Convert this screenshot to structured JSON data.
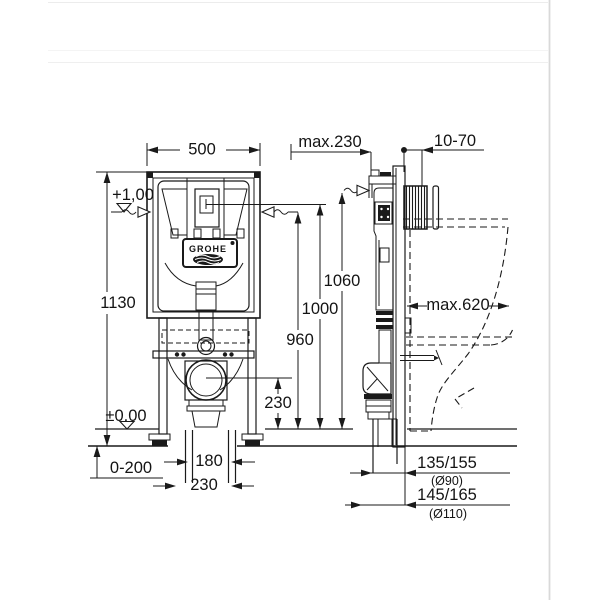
{
  "page": {
    "ink_color": "#1a1a1a",
    "divider_color": "#d9d9d9"
  },
  "front_view": {
    "dim_width_top": "500",
    "dim_height_left": "1130",
    "level_upper": "+1,00",
    "level_floor": "±0,00",
    "dim_floor_buildup": "0-200",
    "dim_pipe_spacing": "180",
    "dim_pipe_offset": "230",
    "dim_outlet_height": "230",
    "brand": "GROHE"
  },
  "side_view": {
    "dim_depth": "max.230",
    "dim_plate_depth": "10-70",
    "dim_h1": "1060",
    "dim_h2": "1000",
    "dim_h3": "960",
    "dim_bowl_depth": "max.620",
    "dim_outlet_a": "135/155",
    "dim_outlet_a_dia": "(Ø90)",
    "dim_outlet_b": "145/165",
    "dim_outlet_b_dia": "(Ø110)"
  }
}
